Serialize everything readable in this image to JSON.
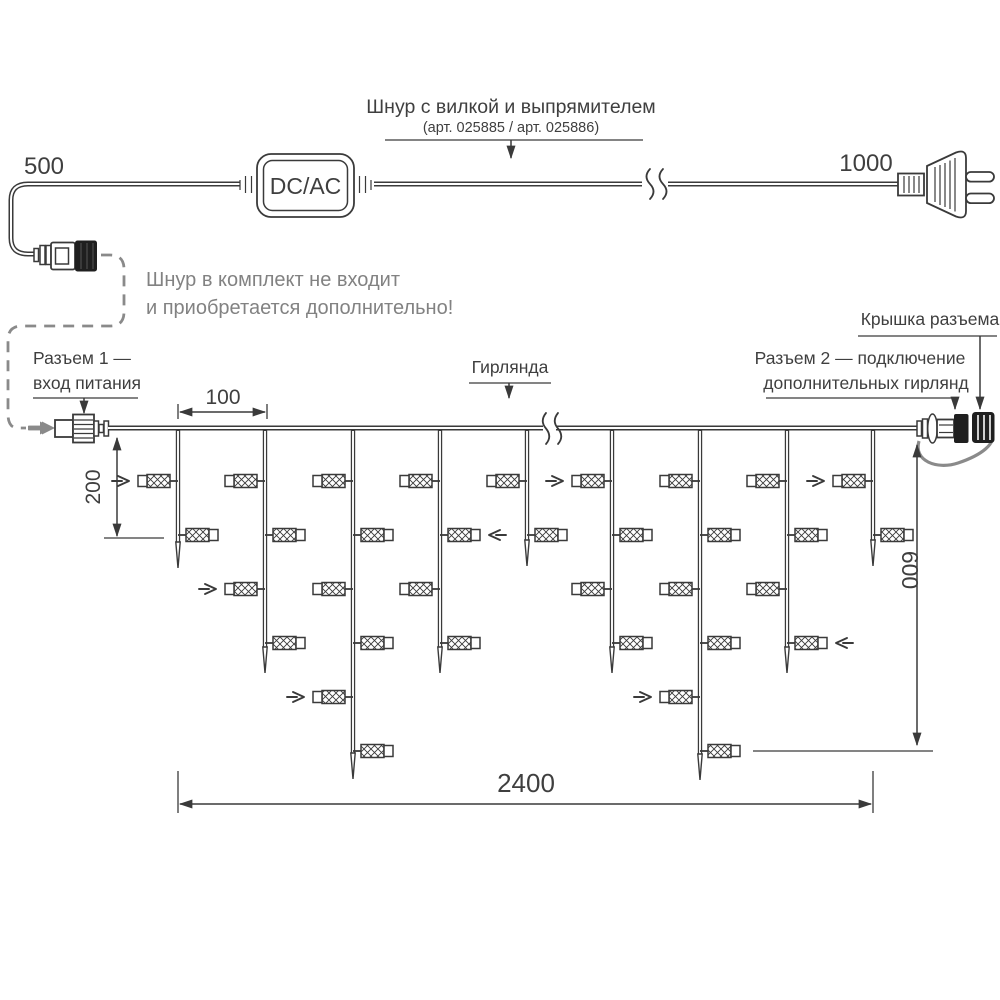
{
  "colors": {
    "line": "#3a3a3a",
    "gray_accent": "#8a8a8a",
    "text": "#3f3f3f",
    "note_text": "#828282",
    "black_part": "#1f1f1f"
  },
  "power_cord": {
    "label": "Шнур с вилкой и выпрямителем",
    "sublabel": "(арт. 025885 / арт. 025886)",
    "left_length": "500",
    "right_length": "1000",
    "converter_label": "DC/AC"
  },
  "note": {
    "line1": "Шнур в комплект не входит",
    "line2": "и приобретается дополнительно!"
  },
  "labels": {
    "connector1_line1": "Разъем 1 —",
    "connector1_line2": "вход питания",
    "garland": "Гирлянда",
    "connector2_line1": "Разъем 2 — подключение",
    "connector2_line2": "дополнительных гирлянд",
    "cap": "Крышка разъема"
  },
  "dimensions": {
    "drop_spacing": "100",
    "first_drop_depth": "200",
    "curtain_height": "600",
    "curtain_length": "2400"
  },
  "garland": {
    "wire_y": 428,
    "wire_x_start": 108,
    "wire_x_end": 917,
    "break_x": 549,
    "lamp_rows": [
      481,
      535,
      589,
      643,
      697,
      751
    ],
    "drops": [
      {
        "x": 178,
        "tip": 568,
        "lamps": [
          {
            "r": 0,
            "s": "L",
            "a": true
          },
          {
            "r": 1,
            "s": "R"
          }
        ]
      },
      {
        "x": 265,
        "tip": 673,
        "lamps": [
          {
            "r": 0,
            "s": "L"
          },
          {
            "r": 1,
            "s": "R"
          },
          {
            "r": 2,
            "s": "L",
            "a": true
          },
          {
            "r": 3,
            "s": "R"
          }
        ]
      },
      {
        "x": 353,
        "tip": 779,
        "lamps": [
          {
            "r": 0,
            "s": "L"
          },
          {
            "r": 1,
            "s": "R"
          },
          {
            "r": 2,
            "s": "L"
          },
          {
            "r": 3,
            "s": "R"
          },
          {
            "r": 4,
            "s": "L",
            "a": true
          },
          {
            "r": 5,
            "s": "R"
          }
        ]
      },
      {
        "x": 440,
        "tip": 673,
        "lamps": [
          {
            "r": 0,
            "s": "L"
          },
          {
            "r": 1,
            "s": "R",
            "a": true
          },
          {
            "r": 2,
            "s": "L"
          },
          {
            "r": 3,
            "s": "R"
          }
        ]
      },
      {
        "x": 527,
        "tip": 566,
        "lamps": [
          {
            "r": 0,
            "s": "L"
          },
          {
            "r": 1,
            "s": "R"
          }
        ]
      },
      {
        "x": 612,
        "tip": 673,
        "lamps": [
          {
            "r": 0,
            "s": "L",
            "a": true
          },
          {
            "r": 1,
            "s": "R"
          },
          {
            "r": 2,
            "s": "L"
          },
          {
            "r": 3,
            "s": "R"
          }
        ]
      },
      {
        "x": 700,
        "tip": 780,
        "lamps": [
          {
            "r": 0,
            "s": "L"
          },
          {
            "r": 1,
            "s": "R"
          },
          {
            "r": 2,
            "s": "L"
          },
          {
            "r": 3,
            "s": "R"
          },
          {
            "r": 4,
            "s": "L",
            "a": true
          },
          {
            "r": 5,
            "s": "R"
          }
        ]
      },
      {
        "x": 787,
        "tip": 673,
        "lamps": [
          {
            "r": 0,
            "s": "L"
          },
          {
            "r": 1,
            "s": "R"
          },
          {
            "r": 2,
            "s": "L"
          },
          {
            "r": 3,
            "s": "R",
            "a": true
          }
        ]
      },
      {
        "x": 873,
        "tip": 566,
        "lamps": [
          {
            "r": 0,
            "s": "L",
            "a": true
          },
          {
            "r": 1,
            "s": "R"
          }
        ]
      }
    ]
  }
}
